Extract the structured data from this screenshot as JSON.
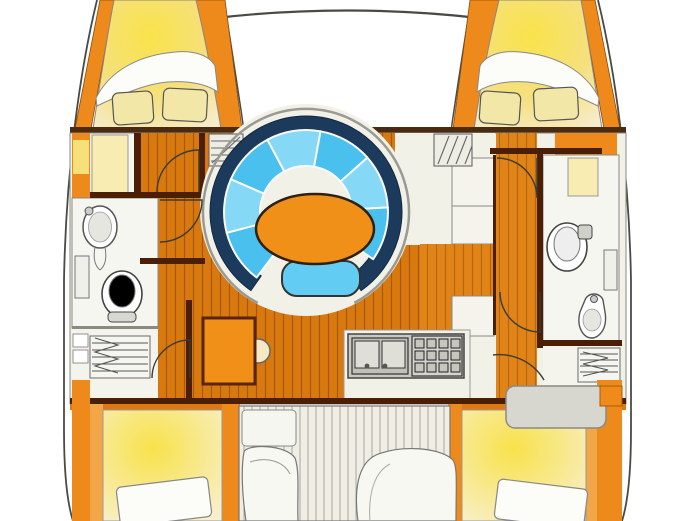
{
  "meta": {
    "title": "Catamaran interior layout floor plan",
    "type": "boat-floor-plan-illustration",
    "visible_text": []
  },
  "colors": {
    "hull_outline": "#4a4a45",
    "deck_orange": "#ee8a1c",
    "deck_orange_dark": "#e07812",
    "deck_orange_light": "#f2a648",
    "wood_base": "#d8790f",
    "wood_line": "#a8570a",
    "wood_right": "#e08418",
    "wall_brown": "#4a1f06",
    "salon_cream": "#f2f1e8",
    "bath_white": "#f6f6f0",
    "bed_yellow": "#f9e34a",
    "bed_cream": "#f6edcd",
    "pillow_yellow": "#f2e7a6",
    "blanket_white": "#fcfcf8",
    "settee_navy": "#1c3a5c",
    "cushion_blue": "#49c0ee",
    "cushion_blue_light": "#85d9f6",
    "table_orange": "#f09018",
    "bench_blue": "#62ccf2",
    "galley_gray": "#c9c9c2",
    "counter_white": "#f4f3ec",
    "cockpit_base": "#efede4",
    "cockpit_slat": "#a8a8a0",
    "bench_gray": "#d7d6cf",
    "wardrobe_yellow": "#f8ecb2",
    "glow_yellow": "#f6e07a"
  },
  "features": [
    {
      "id": "port-bow-cabin",
      "label": "port bow berth with two pillows and duvet"
    },
    {
      "id": "starboard-bow-cabin",
      "label": "starboard bow berth with two pillows and duvet"
    },
    {
      "id": "trampoline",
      "label": "foredeck trampoline with crossbeam"
    },
    {
      "id": "salon-settee",
      "label": "curved navy settee with blue cushions"
    },
    {
      "id": "salon-table",
      "label": "oval orange salon table"
    },
    {
      "id": "salon-bench",
      "label": "blue footstool bench"
    },
    {
      "id": "nav-station",
      "label": "chart table desk with round seat"
    },
    {
      "id": "galley",
      "label": "galley with double sink and stove"
    },
    {
      "id": "port-head",
      "label": "port bathroom with sink and toilet"
    },
    {
      "id": "starboard-head",
      "label": "starboard bathroom with toilet and sink"
    },
    {
      "id": "port-stairs",
      "label": "port hull companionway stairs"
    },
    {
      "id": "starboard-stairs",
      "label": "starboard hull companionway stairs"
    },
    {
      "id": "port-aft-cabin",
      "label": "port aft berth with pillow"
    },
    {
      "id": "starboard-aft-cabin",
      "label": "starboard aft berth with pillow"
    },
    {
      "id": "cockpit",
      "label": "aft cockpit with slatted floor and seats"
    }
  ]
}
